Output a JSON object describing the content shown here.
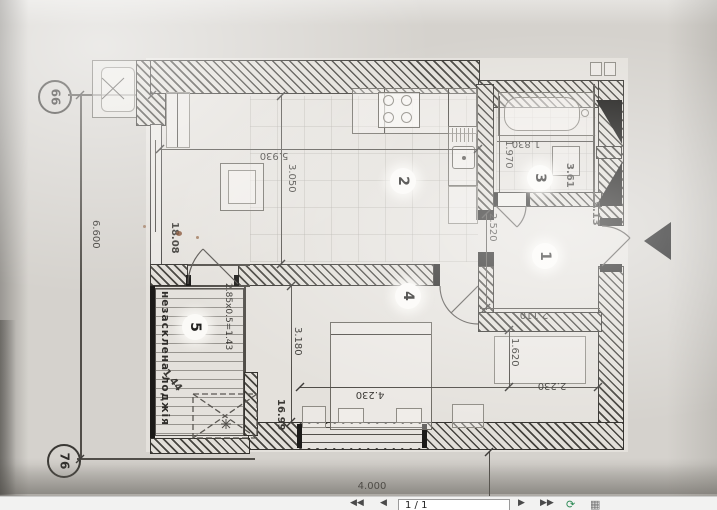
{
  "viewer_toolbar": {
    "first": "◀◀",
    "prev": "◀",
    "page_indicator": "1 / 1",
    "next": "▶",
    "last": "▶▶",
    "rotate_icon": "⟳",
    "thumbnails_icon": "▦"
  },
  "floor_plan": {
    "axis_markers": {
      "top": "66",
      "bottom": "76"
    },
    "overall_dims": {
      "side": "6.600",
      "bottom": "4.000"
    },
    "rooms": [
      {
        "number": "1",
        "area": "5.13",
        "width": "2.110",
        "height": "2.520"
      },
      {
        "number": "2",
        "area": "18.08",
        "width": "5.930",
        "height": "3.050"
      },
      {
        "number": "3",
        "area": "3.61",
        "width": "1.830",
        "height": "1.970"
      },
      {
        "number": "4",
        "area": "16.99",
        "width": "4.230",
        "height": "3.180",
        "niche_width": "2.230",
        "niche_height": "1.620"
      },
      {
        "number": "5",
        "area": "1.44",
        "size_formula": "2.85х0.5=1.43",
        "label": "незасклена лоджія"
      }
    ]
  }
}
